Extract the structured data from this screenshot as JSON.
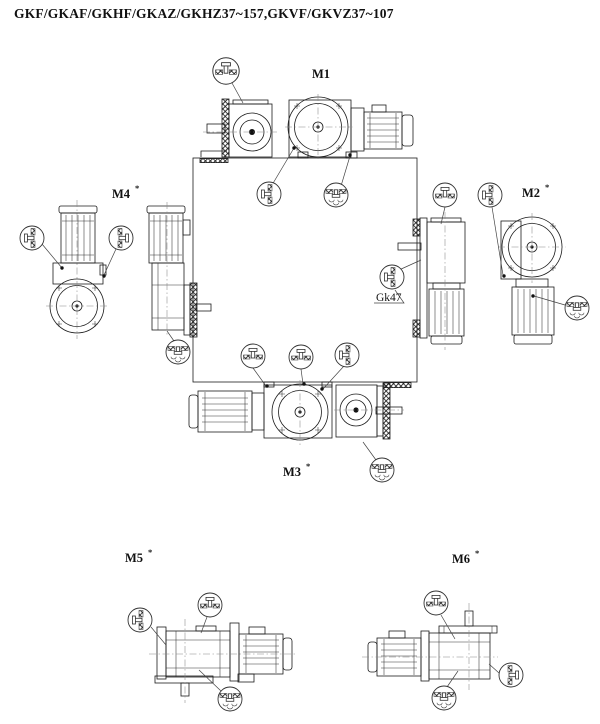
{
  "page": {
    "background": "#ffffff",
    "ink": "#1b1b1b"
  },
  "title": "GKF/GKAF/GKHF/GKAZ/GKHZ37~157,GKVF/GKVZ37~107",
  "figure": {
    "callout": "Gk47",
    "positions": [
      {
        "id": "M1",
        "label": "M1",
        "mark": ""
      },
      {
        "id": "M2",
        "label": "M2",
        "mark": "*"
      },
      {
        "id": "M3",
        "label": "M3",
        "mark": "*"
      },
      {
        "id": "M4",
        "label": "M4",
        "mark": "*"
      },
      {
        "id": "M5",
        "label": "M5",
        "mark": "*"
      },
      {
        "id": "M6",
        "label": "M6",
        "mark": "*"
      }
    ],
    "icons": {
      "vent": "vent-plug-icon",
      "level": "oil-level-plug-icon",
      "drain": "oil-drain-plug-icon"
    }
  }
}
